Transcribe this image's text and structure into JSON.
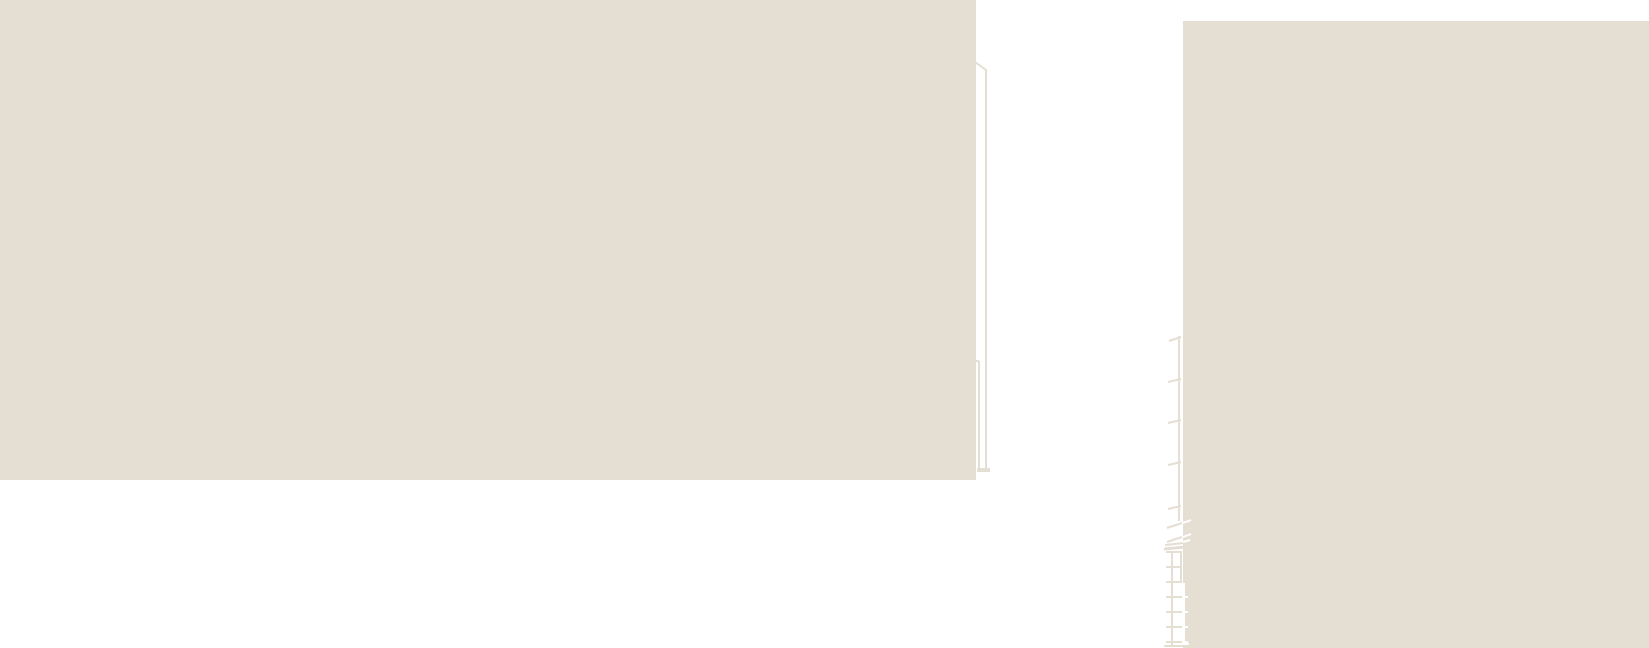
{
  "canvas": {
    "width": 1649,
    "height": 648,
    "background_color": "#ffffff"
  },
  "palette": {
    "wall_beige": "#e5ded2",
    "detail_white": "#ffffff"
  },
  "shapes": [
    {
      "name": "left-wall-block",
      "type": "rect",
      "x": 0,
      "y": 0,
      "w": 976,
      "h": 480,
      "fill": "#e5ded2"
    },
    {
      "name": "right-wall-block",
      "type": "rect",
      "x": 1183,
      "y": 21,
      "w": 466,
      "h": 627,
      "fill": "#e5ded2"
    },
    {
      "name": "downpipe-cap-diagonal",
      "type": "line",
      "x1": 975,
      "y1": 62,
      "x2": 986,
      "y2": 70,
      "stroke": "#e5ded2",
      "w": 2
    },
    {
      "name": "downpipe-outer-rail",
      "type": "line",
      "x1": 986,
      "y1": 69,
      "x2": 986,
      "y2": 469,
      "stroke": "#e5ded2",
      "w": 2
    },
    {
      "name": "downpipe-bracket",
      "type": "line",
      "x1": 975,
      "y1": 361,
      "x2": 979,
      "y2": 361,
      "stroke": "#e5ded2",
      "w": 2
    },
    {
      "name": "downpipe-inner-rail",
      "type": "line",
      "x1": 979,
      "y1": 361,
      "x2": 979,
      "y2": 468,
      "stroke": "#e5ded2",
      "w": 2
    },
    {
      "name": "downpipe-foot",
      "type": "rect",
      "x": 977,
      "y": 468,
      "w": 13,
      "h": 4,
      "fill": "#e5ded2"
    },
    {
      "name": "ladder-leader-line",
      "type": "line",
      "x1": 1179,
      "y1": 336,
      "x2": 1179,
      "y2": 521,
      "stroke": "#e5ded2",
      "w": 2
    },
    {
      "name": "leader-tick-1",
      "type": "line",
      "x1": 1169,
      "y1": 341,
      "x2": 1181,
      "y2": 337,
      "stroke": "#e5ded2",
      "w": 2
    },
    {
      "name": "leader-tick-2",
      "type": "line",
      "x1": 1168,
      "y1": 382,
      "x2": 1181,
      "y2": 379,
      "stroke": "#e5ded2",
      "w": 2
    },
    {
      "name": "leader-tick-3",
      "type": "line",
      "x1": 1168,
      "y1": 423,
      "x2": 1181,
      "y2": 420,
      "stroke": "#e5ded2",
      "w": 2
    },
    {
      "name": "leader-tick-4",
      "type": "line",
      "x1": 1168,
      "y1": 465,
      "x2": 1181,
      "y2": 462,
      "stroke": "#e5ded2",
      "w": 2
    },
    {
      "name": "leader-tick-5",
      "type": "line",
      "x1": 1168,
      "y1": 509,
      "x2": 1181,
      "y2": 506,
      "stroke": "#e5ded2",
      "w": 2
    },
    {
      "name": "break-mark-upper",
      "type": "line",
      "x1": 1167,
      "y1": 528,
      "x2": 1182,
      "y2": 523,
      "stroke": "#e5ded2",
      "w": 2
    },
    {
      "name": "break-mark-upper-overlap",
      "type": "line",
      "x1": 1183,
      "y1": 523,
      "x2": 1191,
      "y2": 520,
      "stroke": "#ffffff",
      "w": 2
    },
    {
      "name": "break-mark-lower",
      "type": "line",
      "x1": 1167,
      "y1": 542,
      "x2": 1182,
      "y2": 537,
      "stroke": "#e5ded2",
      "w": 2
    },
    {
      "name": "break-mark-lower-overlap",
      "type": "line",
      "x1": 1183,
      "y1": 537,
      "x2": 1191,
      "y2": 534,
      "stroke": "#ffffff",
      "w": 2
    },
    {
      "name": "hatch-stroke-1",
      "type": "line",
      "x1": 1165,
      "y1": 545,
      "x2": 1184,
      "y2": 543,
      "stroke": "#e5ded2",
      "w": 2
    },
    {
      "name": "hatch-stroke-2",
      "type": "line",
      "x1": 1164,
      "y1": 549,
      "x2": 1185,
      "y2": 547,
      "stroke": "#e5ded2",
      "w": 3
    },
    {
      "name": "hatch-stroke-overlap",
      "type": "line",
      "x1": 1183,
      "y1": 542,
      "x2": 1190,
      "y2": 540,
      "stroke": "#ffffff",
      "w": 2
    },
    {
      "name": "ladder-left-rail",
      "type": "line",
      "x1": 1172,
      "y1": 551,
      "x2": 1172,
      "y2": 646,
      "stroke": "#e5ded2",
      "w": 2
    },
    {
      "name": "ladder-right-rail",
      "type": "line",
      "x1": 1181,
      "y1": 551,
      "x2": 1181,
      "y2": 583,
      "stroke": "#e5ded2",
      "w": 2
    },
    {
      "name": "ladder-right-rail-overlap",
      "type": "line",
      "x1": 1184,
      "y1": 583,
      "x2": 1184,
      "y2": 644,
      "stroke": "#ffffff",
      "w": 2
    },
    {
      "name": "ladder-rung-1",
      "type": "line",
      "x1": 1166,
      "y1": 552,
      "x2": 1182,
      "y2": 552,
      "stroke": "#e5ded2",
      "w": 2
    },
    {
      "name": "ladder-rung-2",
      "type": "line",
      "x1": 1166,
      "y1": 567,
      "x2": 1182,
      "y2": 567,
      "stroke": "#e5ded2",
      "w": 2
    },
    {
      "name": "ladder-rung-3",
      "type": "line",
      "x1": 1166,
      "y1": 582,
      "x2": 1182,
      "y2": 582,
      "stroke": "#e5ded2",
      "w": 2
    },
    {
      "name": "ladder-rung-4",
      "type": "line",
      "x1": 1166,
      "y1": 597,
      "x2": 1182,
      "y2": 597,
      "stroke": "#e5ded2",
      "w": 2
    },
    {
      "name": "ladder-rung-5",
      "type": "line",
      "x1": 1166,
      "y1": 612,
      "x2": 1182,
      "y2": 612,
      "stroke": "#e5ded2",
      "w": 2
    },
    {
      "name": "ladder-rung-6",
      "type": "line",
      "x1": 1166,
      "y1": 627,
      "x2": 1182,
      "y2": 627,
      "stroke": "#e5ded2",
      "w": 2
    },
    {
      "name": "ladder-rung-7",
      "type": "line",
      "x1": 1166,
      "y1": 642,
      "x2": 1182,
      "y2": 642,
      "stroke": "#e5ded2",
      "w": 2
    },
    {
      "name": "ladder-rung-4-overlap",
      "type": "line",
      "x1": 1182,
      "y1": 597,
      "x2": 1188,
      "y2": 597,
      "stroke": "#ffffff",
      "w": 2
    },
    {
      "name": "ladder-rung-5-overlap",
      "type": "line",
      "x1": 1182,
      "y1": 612,
      "x2": 1188,
      "y2": 612,
      "stroke": "#ffffff",
      "w": 2
    },
    {
      "name": "ladder-rung-6-overlap",
      "type": "line",
      "x1": 1182,
      "y1": 627,
      "x2": 1188,
      "y2": 627,
      "stroke": "#ffffff",
      "w": 2
    },
    {
      "name": "ladder-rung-7-overlap",
      "type": "line",
      "x1": 1182,
      "y1": 642,
      "x2": 1188,
      "y2": 642,
      "stroke": "#ffffff",
      "w": 2
    },
    {
      "name": "ladder-base",
      "type": "line",
      "x1": 1164,
      "y1": 646,
      "x2": 1183,
      "y2": 646,
      "stroke": "#e5ded2",
      "w": 2
    },
    {
      "name": "ladder-base-overlap",
      "type": "line",
      "x1": 1183,
      "y1": 644,
      "x2": 1189,
      "y2": 644,
      "stroke": "#ffffff",
      "w": 2
    }
  ]
}
